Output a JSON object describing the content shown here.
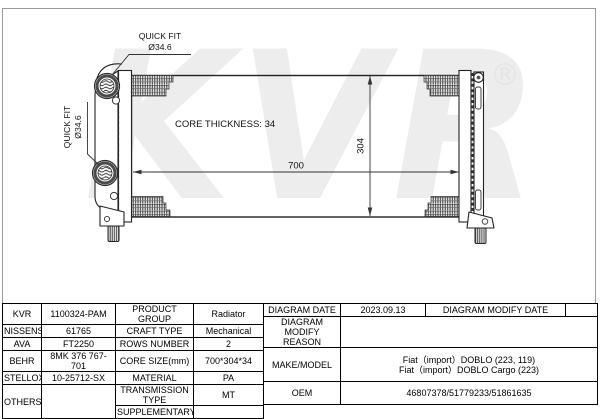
{
  "colors": {
    "line": "#222222",
    "dim": "#333333",
    "watermark": "#ededed",
    "table_border": "#000000",
    "fin_background": "#f3f3f3"
  },
  "watermark": {
    "text": "KVR",
    "registered": "®"
  },
  "drawing": {
    "labels": {
      "quick_fit_top_line1": "QUICK FIT",
      "quick_fit_top_line2": "Ø34.6",
      "quick_fit_side_line1": "QUICK FIT",
      "quick_fit_side_line2": "Ø34.6",
      "core_thickness": "CORE THICKNESS: 34",
      "width_dim": "700",
      "height_dim": "304"
    }
  },
  "spec_table": {
    "rows": [
      {
        "cells": [
          "KVR",
          "1100324-PAM",
          "PRODUCT GROUP",
          "Radiator"
        ]
      },
      {
        "cells": [
          "NISSENS",
          "61765",
          "CRAFT TYPE",
          "Mechanical"
        ]
      },
      {
        "cells": [
          "AVA",
          "FT2250",
          "ROWS NUMBER",
          "2"
        ]
      },
      {
        "cells": [
          "BEHR",
          "8MK 376 767-701",
          "CORE SIZE(mm)",
          "700*304*34"
        ]
      },
      {
        "cells": [
          "STELLOX",
          "10-25712-SX",
          "MATERIAL",
          "PA"
        ]
      },
      {
        "cells": [
          "OTHERS",
          "",
          "TRANSMISSION TYPE",
          "MT"
        ]
      },
      {
        "cells": [
          "SUPPLEMENTARY",
          ""
        ]
      }
    ]
  },
  "info_table": {
    "r1": [
      "DIAGRAM DATE",
      "2023.09.13",
      "DIAGRAM MODIFY DATE",
      ""
    ],
    "r2_label": "DIAGRAM MODIFY REASON",
    "r2_value": "",
    "r3_label": "MAKE/MODEL",
    "r3_lines": [
      "Fiat（import）DOBLO (223, 119)",
      "Fiat（import）DOBLO Cargo (223)"
    ],
    "r4_label": "OEM",
    "r4_value": "46807378/51779233/51861635"
  }
}
